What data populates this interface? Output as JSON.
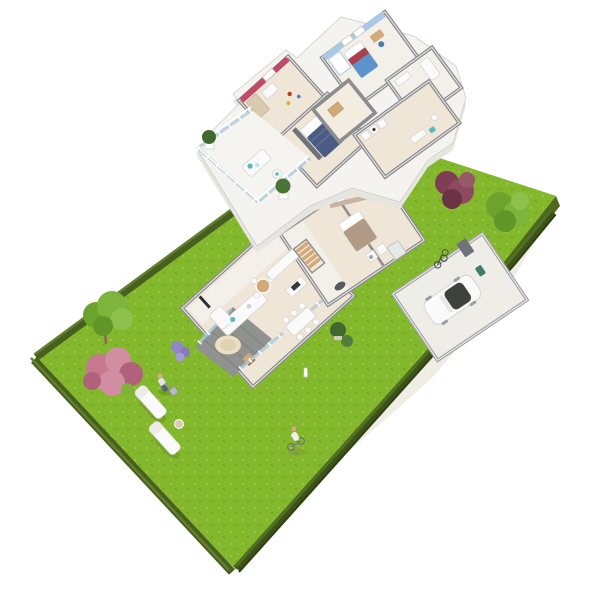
{
  "scene": {
    "kind": "3d-isometric-floor-plan-render",
    "floors": [
      {
        "name": "upper-floor",
        "rooms": [
          "child-room-pink",
          "master-bedroom",
          "bedroom-blue",
          "bathroom-small",
          "bathroom-hall-wing",
          "landing",
          "balcony"
        ],
        "furniture": [
          "wardrobe",
          "desk-with-toys",
          "navy-double-bed",
          "blue-single-bed",
          "white-wardrobe",
          "desk-chair",
          "bathtub",
          "sink-cabinets",
          "lounge-daybed",
          "armchair",
          "potted-conifer",
          "potted-conifer"
        ]
      },
      {
        "name": "ground-floor",
        "rooms": [
          "living-room",
          "kitchen",
          "dining-area",
          "hall-stairs",
          "bedroom",
          "bathroom-laundry",
          "garage",
          "terrace-deck"
        ],
        "furniture": [
          "l-shaped-sofa",
          "tv-panel",
          "round-bistro-table",
          "dining-table-six-chairs",
          "kitchen-island",
          "wood-stairs",
          "taupe-double-bed",
          "washer-dryer",
          "shower",
          "white-car",
          "bicycles",
          "green-bin",
          "round-rug",
          "wood-chair",
          "boxwood-balls",
          "bollard-lamp"
        ]
      }
    ],
    "outdoor": [
      "garden-lawn",
      "back-lawn-strip",
      "driveway-path",
      "perimeter-fence",
      "perimeter-hedge",
      "green-tree",
      "pink-blossom-bush",
      "lavender-bush",
      "burgundy-bush",
      "back-green-tree",
      "sun-lounger",
      "sun-lounger",
      "side-table",
      "gardener-figure",
      "lawn-mower",
      "cyclist-figure"
    ]
  },
  "palette": {
    "bg": "#ffffff",
    "lawn": "#84b82c",
    "lawnShade": "#74a626",
    "lawnSide": "#4e691d",
    "fence": "#47601f",
    "fenceHi": "#638030",
    "hedge": "#3c5319",
    "hedgeHi": "#526f26",
    "wall": "#8d8d90",
    "wallLight": "#a3a3a5",
    "wallDark": "#717276",
    "slab": "#f5f3ef",
    "slabSide": "#e7e5e0",
    "floorWarm": "#efe6d7",
    "floorLight": "#f3f0ea",
    "deck": "#8f928f",
    "deckLine": "#7d807d",
    "drive": "#f0ede5",
    "glass": "#aecbd8",
    "accentPink": "#c04a6a",
    "accentBlue": "#a9c9e6",
    "accentTaupe": "#c9b3a2",
    "bedNavy": "#4a5c84",
    "bedNavyHi": "#5d6f97",
    "bedBlue": "#5d92cc",
    "bedRed": "#ac3f4e",
    "bedTaupe": "#b09a86",
    "sofaWhite": "#fbfafa",
    "teal": "#5bb8c4",
    "wood": "#d2a977",
    "woodDark": "#8a6b4a",
    "rug": "#ecdfc6",
    "car": "#fafafa",
    "carShade": "#d9d9d9",
    "carGlass": "#3c423e",
    "tree1": "#6ba32c",
    "tree2": "#7cb43c",
    "tree3": "#8ec04e",
    "tree4": "#5f9626",
    "conifer": "#41682f",
    "bushPink1": "#c5798f",
    "bushPink2": "#d18da1",
    "bushPink3": "#b0617c",
    "bushRed1": "#7e3d52",
    "bushRed2": "#8d4a5e",
    "bushRed3": "#6b3244",
    "lavender": "#9187cf",
    "skin": "#dca787",
    "binGreen": "#3f7d6a",
    "dark": "#4a4a4c"
  }
}
